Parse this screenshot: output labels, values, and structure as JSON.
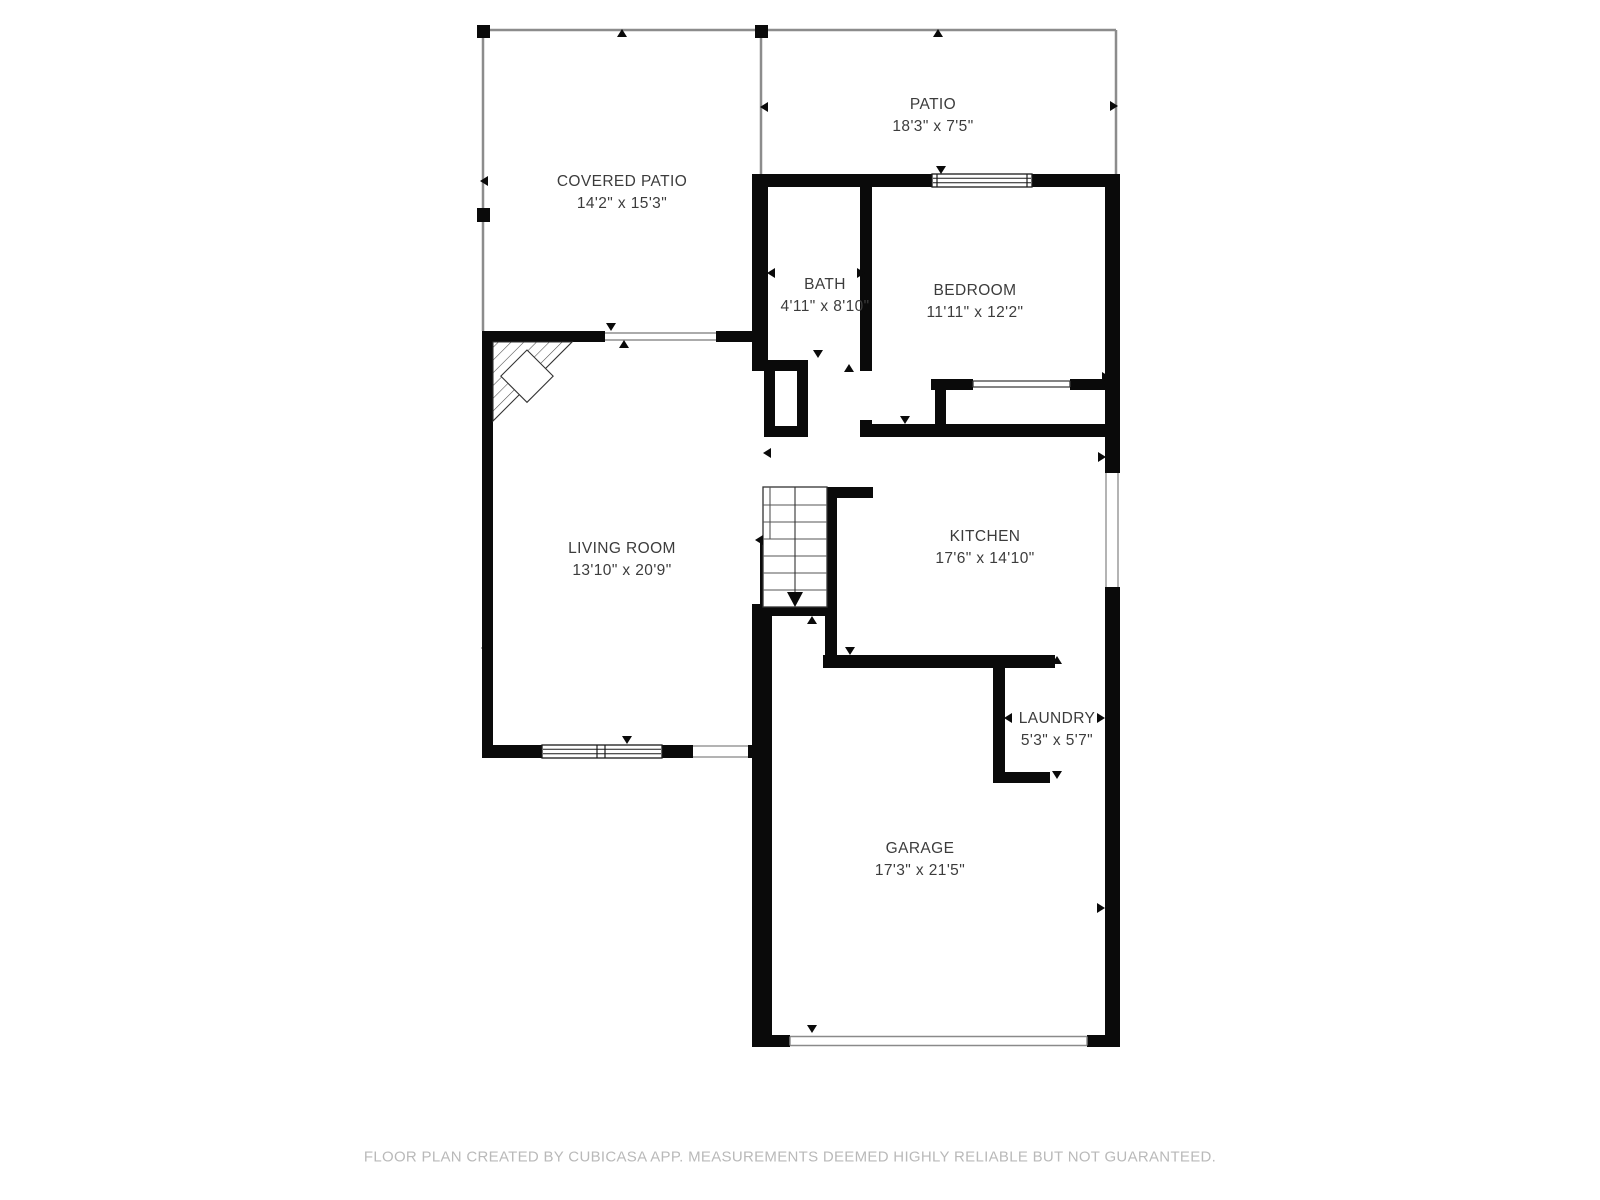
{
  "colors": {
    "wall": "#0a0a0a",
    "thin_wall": "#8c8c8c",
    "label_text": "#3c3c3c",
    "footer_text": "#b9b9b9",
    "background": "#ffffff"
  },
  "rooms": [
    {
      "name": "COVERED PATIO",
      "dims": "14'2\" x 15'3\""
    },
    {
      "name": "PATIO",
      "dims": "18'3\" x 7'5\""
    },
    {
      "name": "BATH",
      "dims": "4'11\" x 8'10\""
    },
    {
      "name": "BEDROOM",
      "dims": "11'11\" x 12'2\""
    },
    {
      "name": "LIVING ROOM",
      "dims": "13'10\" x 20'9\""
    },
    {
      "name": "KITCHEN",
      "dims": "17'6\" x 14'10\""
    },
    {
      "name": "LAUNDRY",
      "dims": "5'3\" x 5'7\""
    },
    {
      "name": "GARAGE",
      "dims": "17'3\" x 21'5\""
    }
  ],
  "footer": {
    "text": "FLOOR PLAN CREATED BY CUBICASA APP. MEASUREMENTS DEEMED HIGHLY RELIABLE BUT NOT GUARANTEED."
  }
}
